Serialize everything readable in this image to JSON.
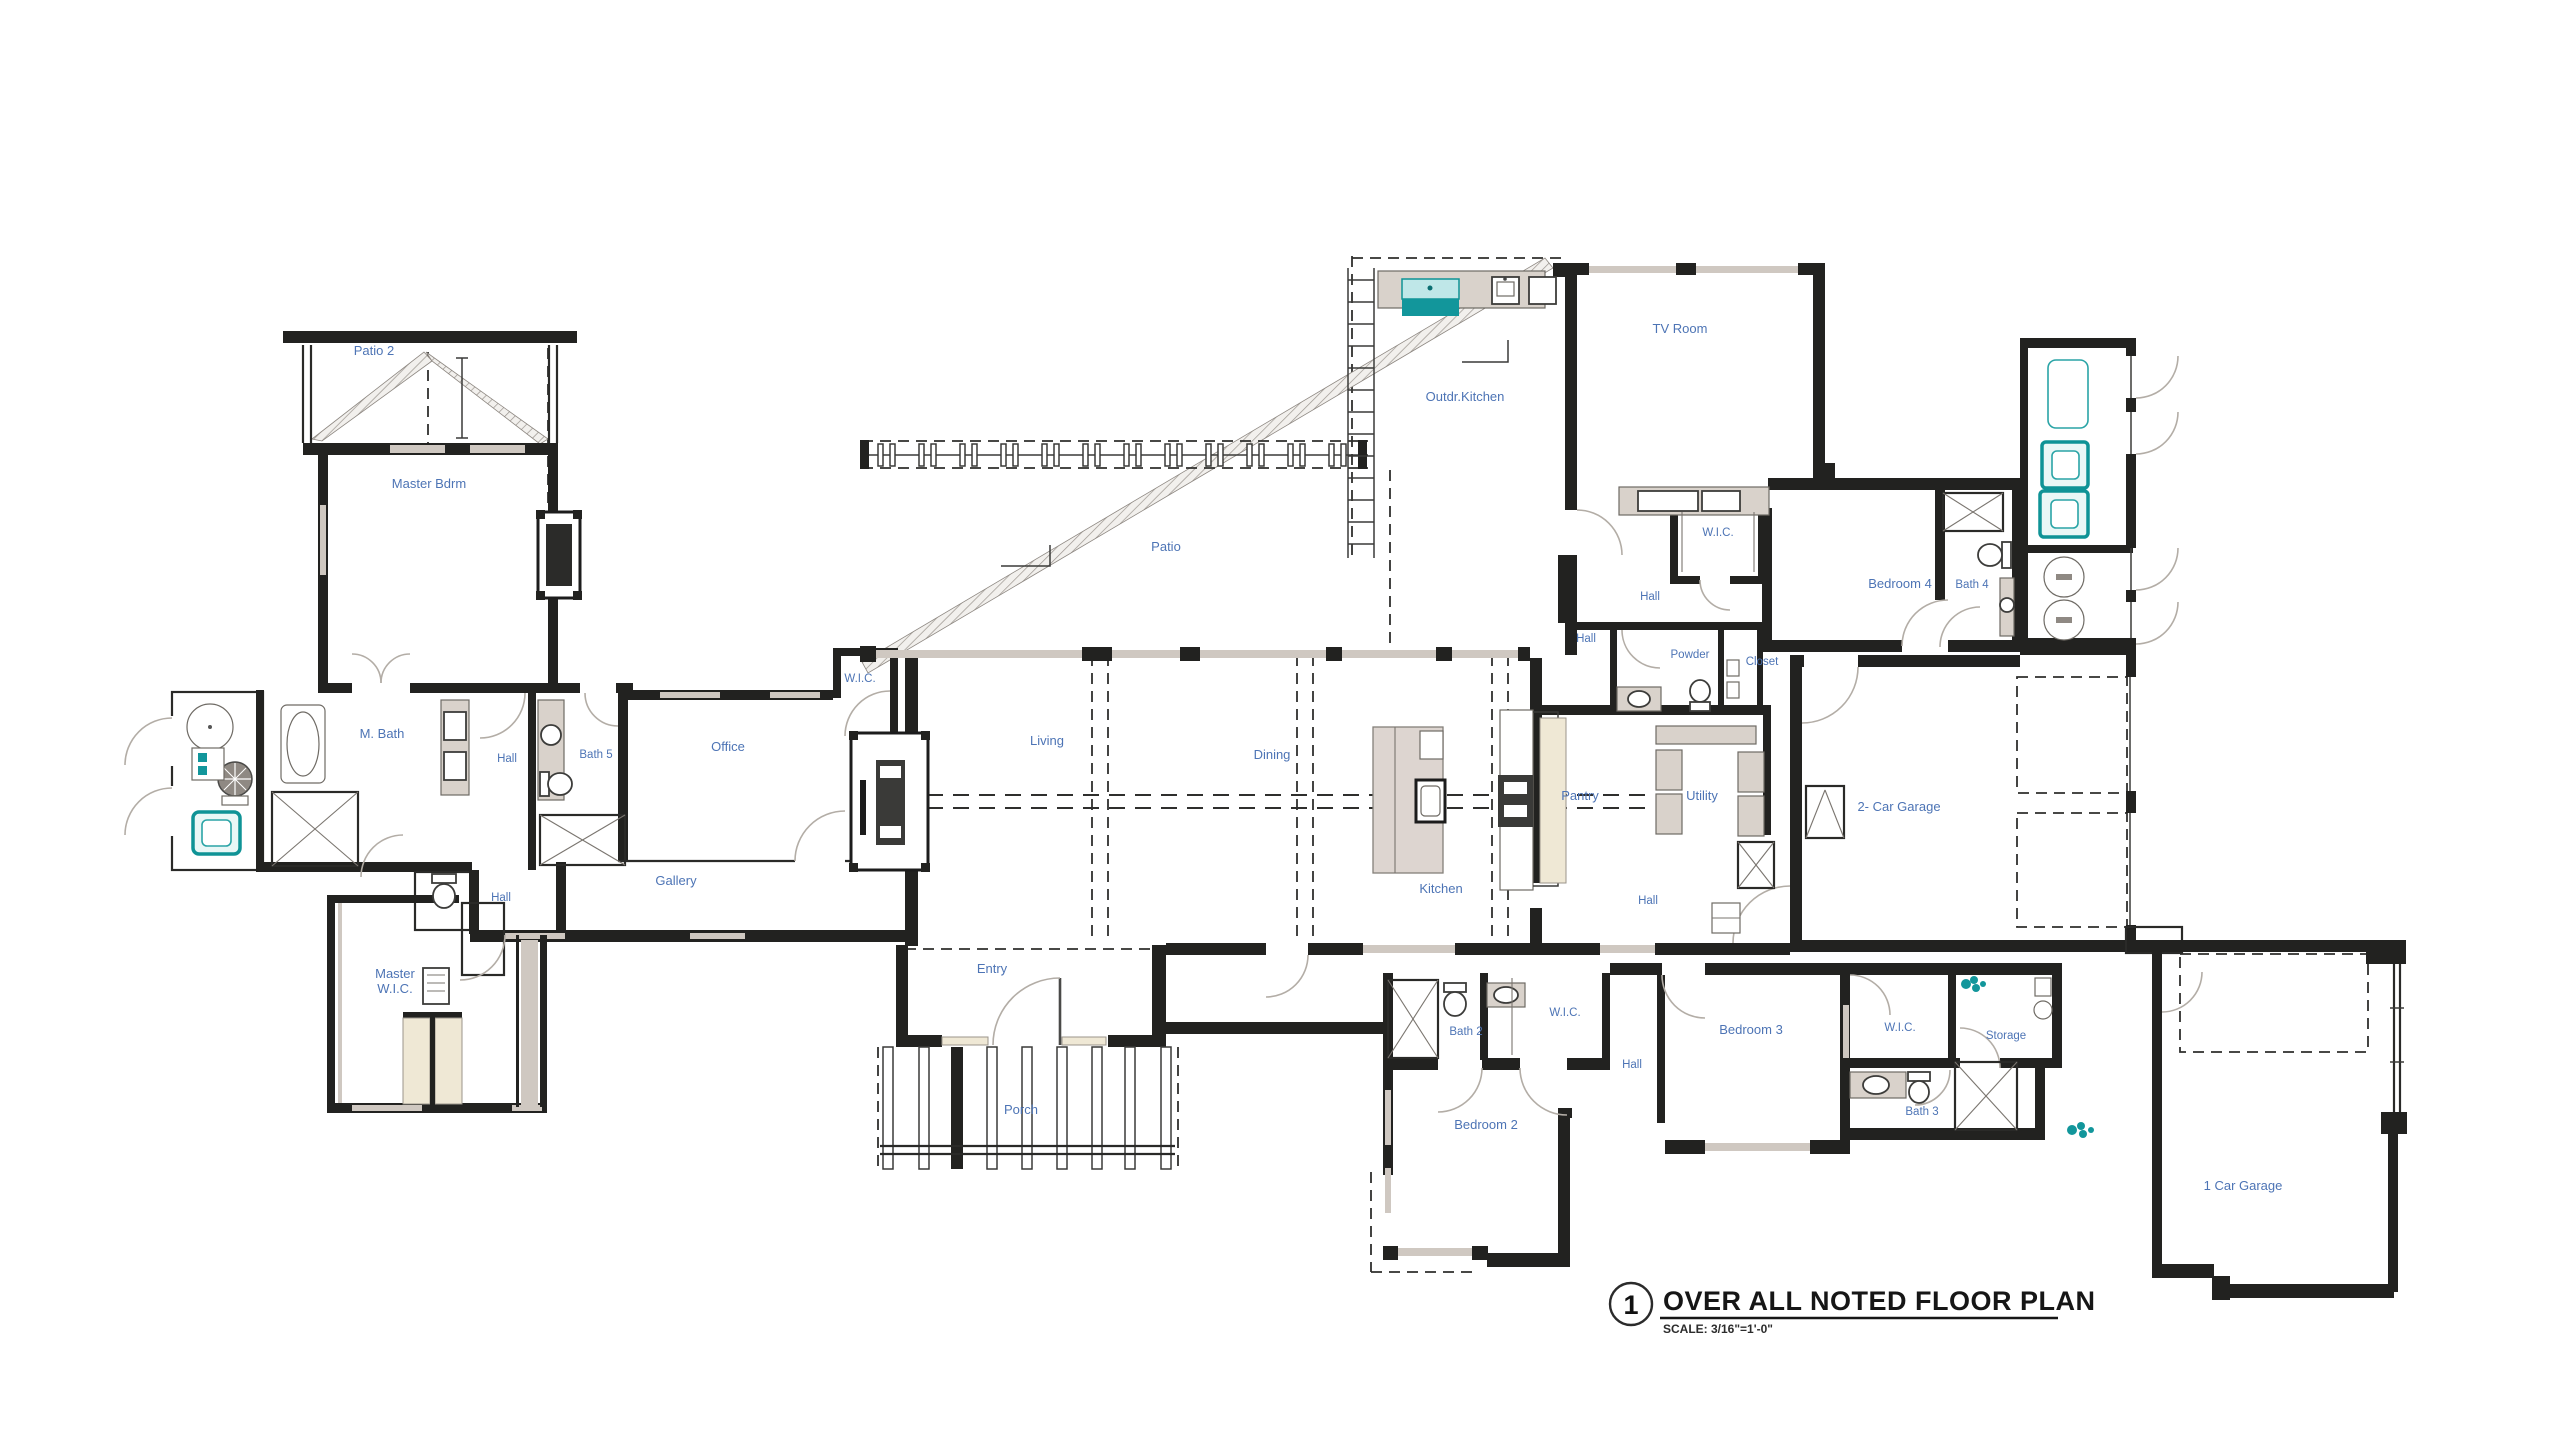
{
  "rooms": [
    {
      "label": "Patio 2"
    },
    {
      "label": "Master Bdrm"
    },
    {
      "label": "M. Bath"
    },
    {
      "label": "Hall"
    },
    {
      "label": "Bath 5"
    },
    {
      "label": "Hall"
    },
    {
      "label": "Master",
      "label2": "W.I.C."
    },
    {
      "label": "Office"
    },
    {
      "label": "W.I.C."
    },
    {
      "label": "Gallery"
    },
    {
      "label": "Patio"
    },
    {
      "label": "Living"
    },
    {
      "label": "Dining"
    },
    {
      "label": "Entry"
    },
    {
      "label": "Porch"
    },
    {
      "label": "Outdr.Kitchen"
    },
    {
      "label": "TV Room"
    },
    {
      "label": "W.I.C."
    },
    {
      "label": "Hall"
    },
    {
      "label": "Hall"
    },
    {
      "label": "Powder"
    },
    {
      "label": "Closet"
    },
    {
      "label": "Bedroom 4"
    },
    {
      "label": "Bath 4"
    },
    {
      "label": "Kitchen"
    },
    {
      "label": "Pantry"
    },
    {
      "label": "Utility"
    },
    {
      "label": "Hall"
    },
    {
      "label": "2- Car Garage"
    },
    {
      "label": "Bath 2"
    },
    {
      "label": "W.I.C."
    },
    {
      "label": "Hall"
    },
    {
      "label": "Bedroom 2"
    },
    {
      "label": "Bedroom 3"
    },
    {
      "label": "W.I.C."
    },
    {
      "label": "Storage"
    },
    {
      "label": "Bath 3"
    },
    {
      "label": "1 Car Garage"
    }
  ],
  "title_block": {
    "number": "1",
    "title": "OVER ALL NOTED FLOOR PLAN",
    "scale": "SCALE: 3/16\"=1'-0\""
  },
  "icons": [
    "hot-tub-icon",
    "spa-tub-icon",
    "grill-icon",
    "toilet-icon",
    "sink-icon",
    "shower-icon",
    "tub-icon",
    "washer-dryer-icon",
    "fireplace-icon",
    "car-stall-icon",
    "casement-window-icon",
    "plant-icon",
    "round-table-icon"
  ],
  "colors": {
    "room_label": "#4d74b5",
    "teal_fixture": "#12969b",
    "wall": "#222220",
    "window_band": "#cfc8c1",
    "closet_cream": "#efe8d5"
  }
}
